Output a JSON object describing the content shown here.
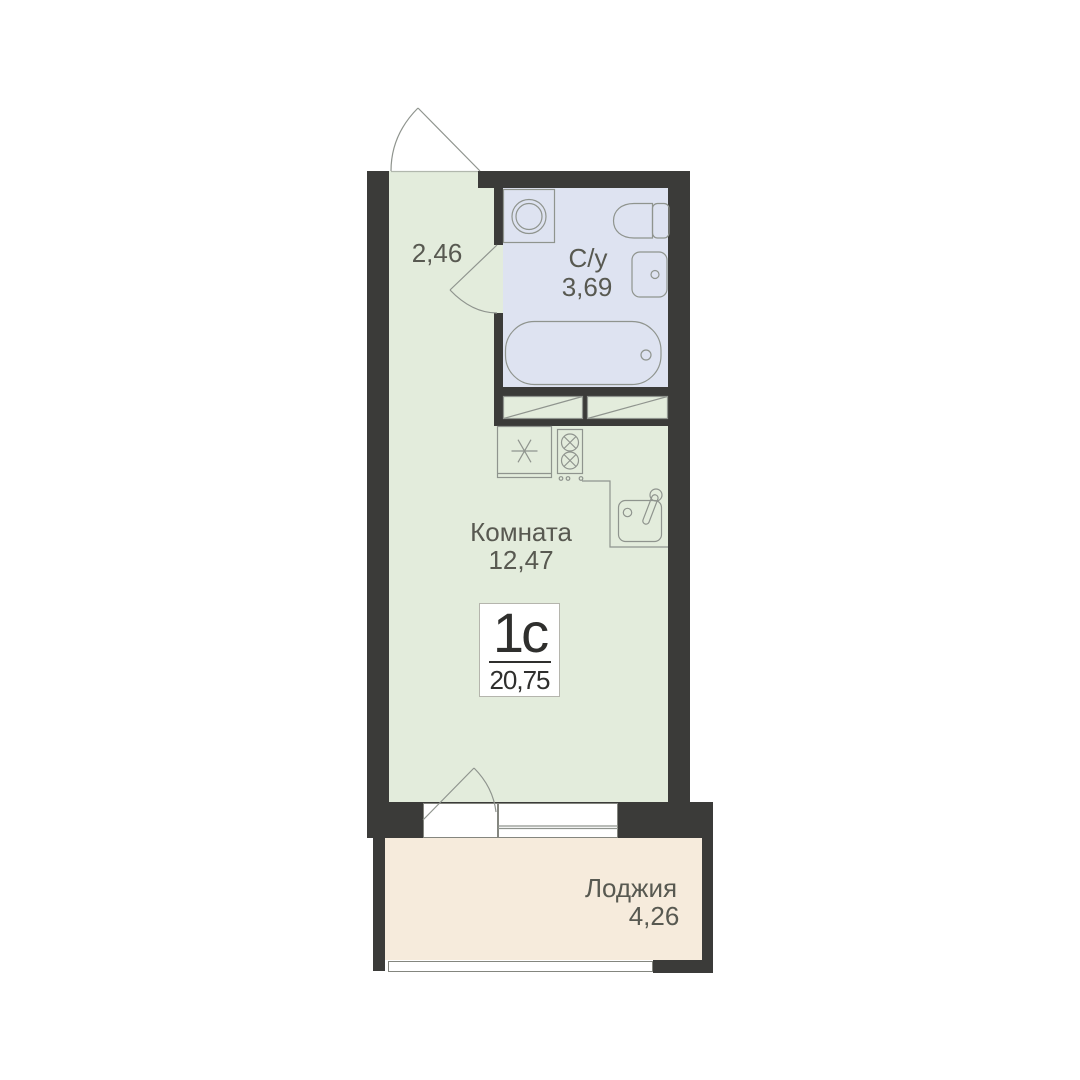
{
  "palette": {
    "bg": "#ffffff",
    "wall": "#3b3b39",
    "room": "#e3ecdc",
    "bath": "#dee3f1",
    "loggia": "#f6ebdc",
    "line": "#8f948e",
    "label": "#585951",
    "ink": "#2f2f2d",
    "openb": "#84867f",
    "plateb": "#b5b5ad"
  },
  "unit_plate": {
    "type_label": "1с",
    "area_label": "20,75"
  },
  "rooms": {
    "hallway": {
      "area_label": "2,46"
    },
    "bathroom": {
      "name_label": "С/у",
      "area_label": "3,69"
    },
    "living": {
      "name_label": "Комната",
      "area_label": "12,47"
    },
    "loggia": {
      "name_label": "Лоджия",
      "area_label": "4,26"
    }
  },
  "fixtures": [
    "washing-machine",
    "toilet",
    "wall-sink",
    "bathtub",
    "wardrobe",
    "wardrobe",
    "fridge",
    "stove",
    "kitchen-sink",
    "kitchen-counter"
  ],
  "openings": [
    "entrance-door",
    "bathroom-door",
    "balcony-door",
    "balcony-window",
    "loggia-window"
  ]
}
